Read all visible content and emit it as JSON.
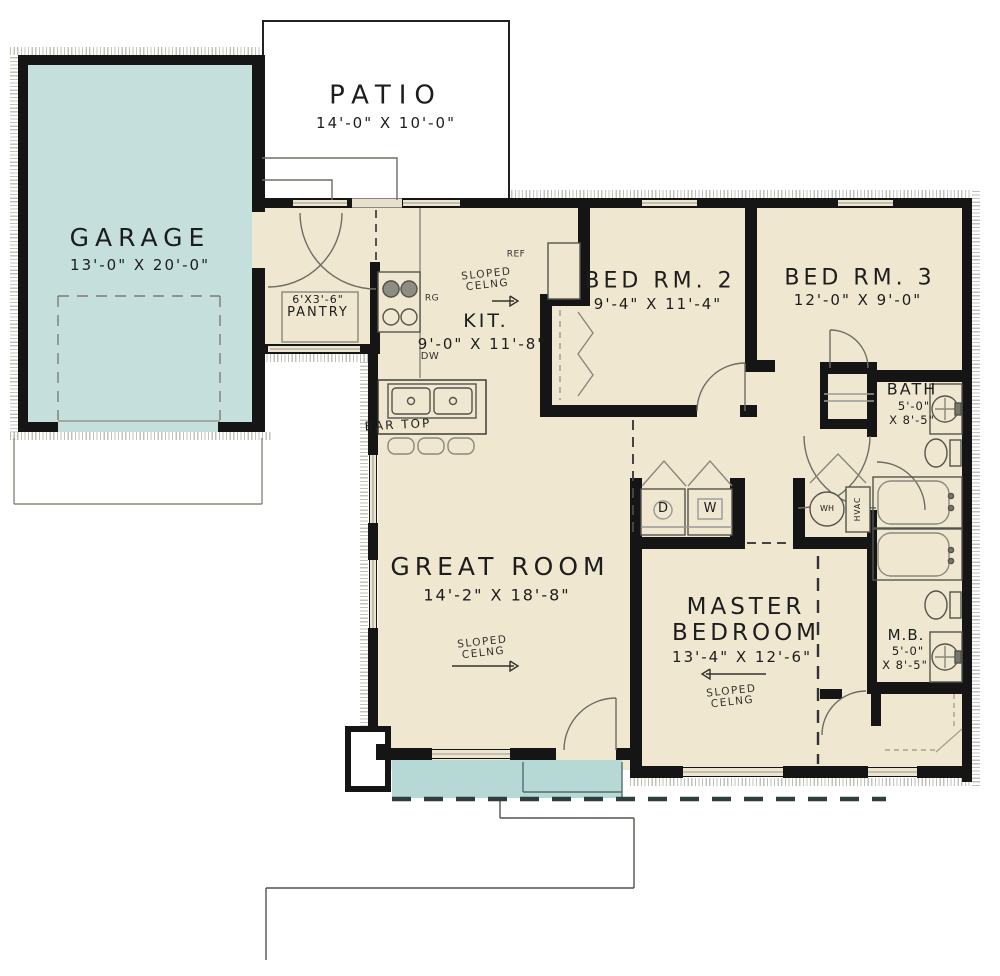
{
  "rooms": {
    "patio": {
      "name": "PATIO",
      "dims": "14'-0\" X 10'-0\""
    },
    "garage": {
      "name": "GARAGE",
      "dims": "13'-0\" X 20'-0\""
    },
    "pantry": {
      "size_label": "6'X3'-6\"",
      "name": "PANTRY"
    },
    "kitchen": {
      "name": "KIT.",
      "dims": "9'-0\" X 11'-8\""
    },
    "bedroom2": {
      "name": "BED RM. 2",
      "dims": "9'-4\" X 11'-4\""
    },
    "bedroom3": {
      "name": "BED RM. 3",
      "dims": "12'-0\" X 9'-0\""
    },
    "bath": {
      "name": "BATH",
      "dims_line1": "5'-0\"",
      "dims_line2": "X 8'-5\""
    },
    "great_room": {
      "name": "GREAT ROOM",
      "dims": "14'-2\" X 18'-8\""
    },
    "master_bedroom": {
      "name_line1": "MASTER",
      "name_line2": "BEDROOM",
      "dims": "13'-4\" X 12'-6\""
    },
    "master_bath": {
      "name": "M.B.",
      "dims_line1": "5'-0\"",
      "dims_line2": "X 8'-5\""
    }
  },
  "annotations": {
    "sloped_ceiling_line1": "SLOPED",
    "sloped_ceiling_line2": "CELNG",
    "bar_top": "BAR TOP",
    "refrigerator": "REF",
    "range": "RG",
    "dishwasher": "DW",
    "dryer": "D",
    "washer": "W",
    "water_heater": "WH",
    "hvac": "HVAC"
  },
  "colors": {
    "wall": "#151515",
    "room_fill": "#efe7d0",
    "garage_fill": "#c4dfdc",
    "porch_fill": "#b7d9d6",
    "line": "#6e6d64",
    "dashed_porch": "#2e3e3c"
  }
}
